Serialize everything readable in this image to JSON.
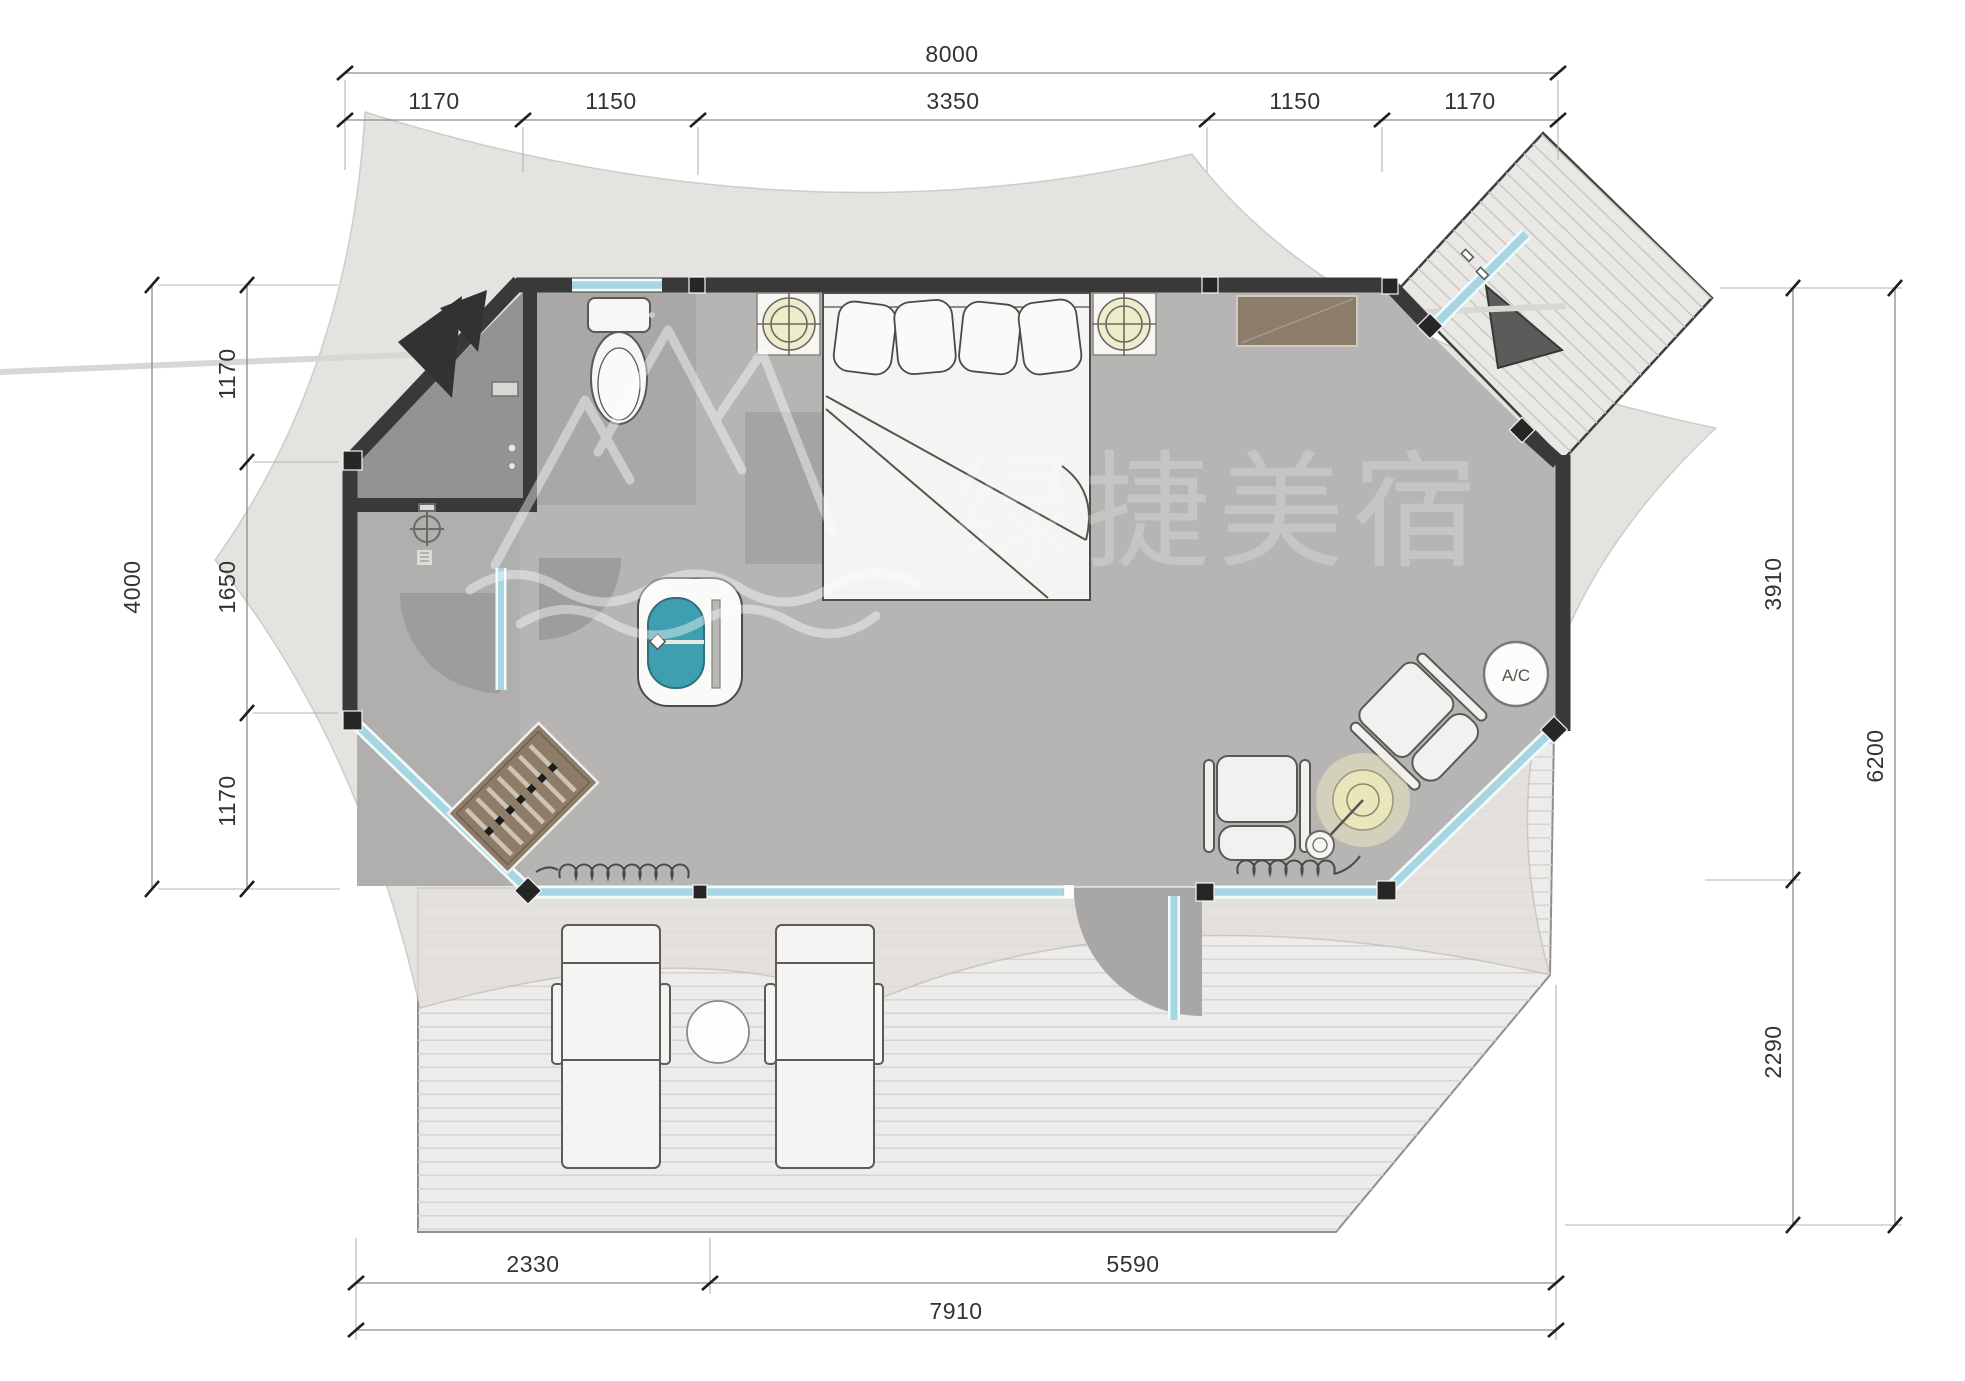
{
  "title": "tent-cabin-floor-plan",
  "watermark": {
    "text": "绿捷美宿",
    "logo": "mountain-wave-logo"
  },
  "labels": {
    "ac": "A/C"
  },
  "dimensions": {
    "top": {
      "total": "8000",
      "segments": [
        "1170",
        "1150",
        "3350",
        "1150",
        "1170"
      ]
    },
    "left": {
      "total": "4000",
      "segments": [
        "1170",
        "1650",
        "1170"
      ]
    },
    "right": {
      "total": "6200",
      "segments": [
        "3910",
        "2290"
      ]
    },
    "bottom": {
      "total": "7910",
      "segments": [
        "2330",
        "5590"
      ]
    }
  },
  "colors": {
    "wall": "#3a3939",
    "glass": "#a6d6e2",
    "floor": "#b6b5b4",
    "canvas": "#e0ded9",
    "deck": "#edecea",
    "basin_teal": "#3e9fb0",
    "console_brown": "#8c7d6b",
    "lamp_glow": "#efecc3"
  }
}
